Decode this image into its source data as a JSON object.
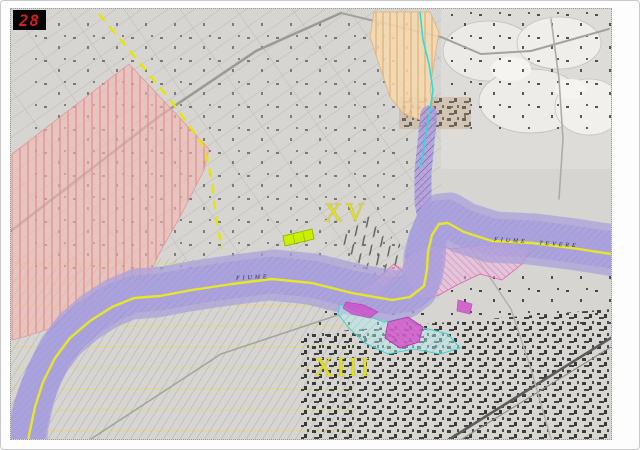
{
  "map": {
    "type": "topographic-planning-map",
    "sheet_number": "28",
    "district_labels": {
      "xv": "XV",
      "xiii": "XIII"
    },
    "river_labels": {
      "west": "FIUME",
      "east_fiume": "FIUME",
      "east_tevere": "TEVERE"
    },
    "colors": {
      "sheet_badge_bg": "#050505",
      "sheet_badge_text": "#d81f1f",
      "district_text": "#e3df1b",
      "base_gray": "#d6d5d2",
      "red_zone_fill": "#f0b9b4",
      "red_zone_hatch": "#e88888",
      "orange_zone_fill": "#f4d9b0",
      "orange_zone_hatch": "#e4a96a",
      "river_corridor_fill": "#a9a1dc",
      "river_corridor_hatch": "#5b52c4",
      "river_bank_line": "#2525c0",
      "river_center_line": "#e6e62a",
      "pink_zone_hatch": "#f070b8",
      "magenta_blob": "#cf4ecb",
      "cyan_zone": "#49cfcf",
      "stream_line": "#28dede",
      "dashed_line_yellow": "#e6e600",
      "highlight_rect_green": "#c8f000"
    }
  }
}
